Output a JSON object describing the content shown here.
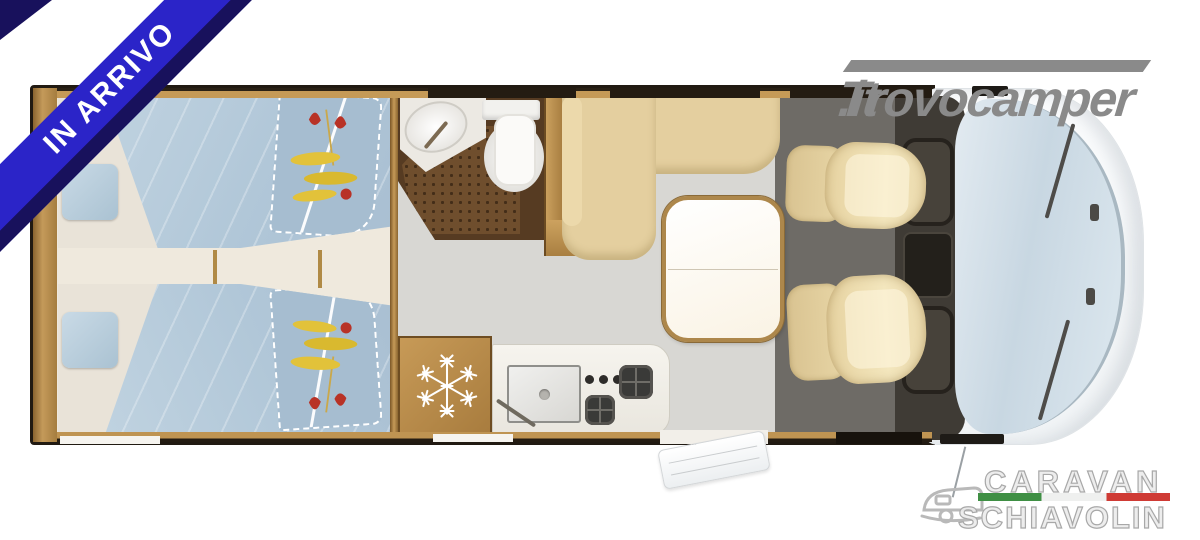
{
  "ribbon": {
    "text": "IN ARRIVO"
  },
  "logos": {
    "trovocamper": {
      "part1": "Trovocamper",
      "part2": ".it"
    },
    "dealer": {
      "line1": "CARAVAN",
      "line2": "SCHIAVOLIN"
    }
  },
  "colors": {
    "ribbon_blue": "#2b24c8",
    "ribbon_shadow_navy": "#18115c",
    "site_logo_gray": "#8a8a8a",
    "flag_green": "#3f8f44",
    "flag_white": "#eff0ef",
    "flag_red": "#cf3b35",
    "wood_trim": "#b98a45",
    "bedding_blue": "#b1c7d8",
    "sofa_beige": "#e4cf9f",
    "bathroom_brown": "#6f4e2d",
    "cab_floor_gray": "#6e6b66",
    "windshield_blue": "#c8d7e2"
  },
  "icons": {
    "fridge": "snowflake-icon",
    "dealer_mark": "caravan-icon"
  },
  "floorplan": {
    "subject": "motorhome-top-view-floorplan",
    "zones": [
      "twin-beds",
      "center-aisle",
      "bathroom",
      "wardrobe",
      "dinette-sofa",
      "dining-table",
      "fridge",
      "kitchen-counter",
      "entry-step",
      "cab-seats",
      "dashboard",
      "windshield",
      "hood"
    ]
  }
}
